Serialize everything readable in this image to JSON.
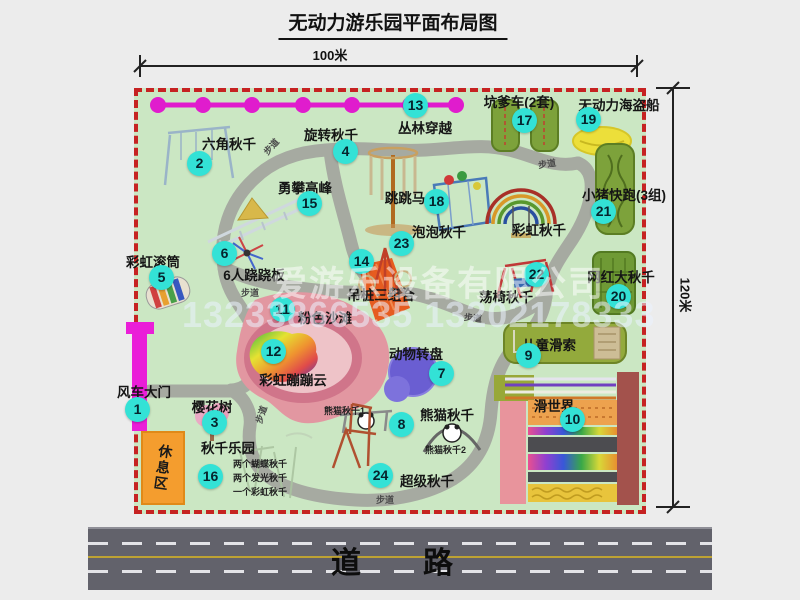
{
  "title": "无动力游乐园平面布局图",
  "dims": {
    "width": "100米",
    "height": "120米"
  },
  "road": {
    "label": "道　路"
  },
  "watermark": {
    "company": "爱游乐设备有限公司",
    "phone": "13233866535 13202178333"
  },
  "rest_area_label": "休息区",
  "path_label": "步道",
  "rainbow_swing_label": "彩虹秋千",
  "panda_labels": [
    "熊猫秋千1",
    "熊猫秋千2"
  ],
  "swing_notes": [
    "两个蝴蝶秋千",
    "两个发光秋千",
    "一个彩虹秋千"
  ],
  "attractions": [
    {
      "num": "1",
      "name": "风车大门"
    },
    {
      "num": "2",
      "name": "六角秋千"
    },
    {
      "num": "3",
      "name": "樱花树"
    },
    {
      "num": "4",
      "name": "旋转秋千"
    },
    {
      "num": "5",
      "name": "彩虹滚筒"
    },
    {
      "num": "6",
      "name": "6人跷跷板"
    },
    {
      "num": "7",
      "name": "动物转盘"
    },
    {
      "num": "8",
      "name": "熊猫秋千"
    },
    {
      "num": "9",
      "name": "儿童滑索"
    },
    {
      "num": "10",
      "name": "滑世界"
    },
    {
      "num": "11",
      "name": "粉色沙滩"
    },
    {
      "num": "12",
      "name": "彩虹蹦蹦云"
    },
    {
      "num": "13",
      "name": "丛林穿越"
    },
    {
      "num": "14",
      "name": "吊桩三组合"
    },
    {
      "num": "15",
      "name": "勇攀高峰"
    },
    {
      "num": "16",
      "name": "秋千乐园"
    },
    {
      "num": "17",
      "name": "坑爹车(2套)"
    },
    {
      "num": "18",
      "name": "跳跳马"
    },
    {
      "num": "19",
      "name": "无动力海盗船"
    },
    {
      "num": "20",
      "name": "网红大秋千"
    },
    {
      "num": "21",
      "name": "小猪快跑(3组)"
    },
    {
      "num": "22",
      "name": "荡椅秋千"
    },
    {
      "num": "23",
      "name": "泡泡秋千"
    },
    {
      "num": "24",
      "name": "超级秋千"
    }
  ],
  "colors": {
    "accent_teal": "#33e2d6",
    "boundary_red": "#c62222",
    "gate_magenta": "#ea1ed8",
    "map_green": "#cbe7c3",
    "path_gray": "#a6aaa1",
    "road_gray": "#62626b"
  }
}
